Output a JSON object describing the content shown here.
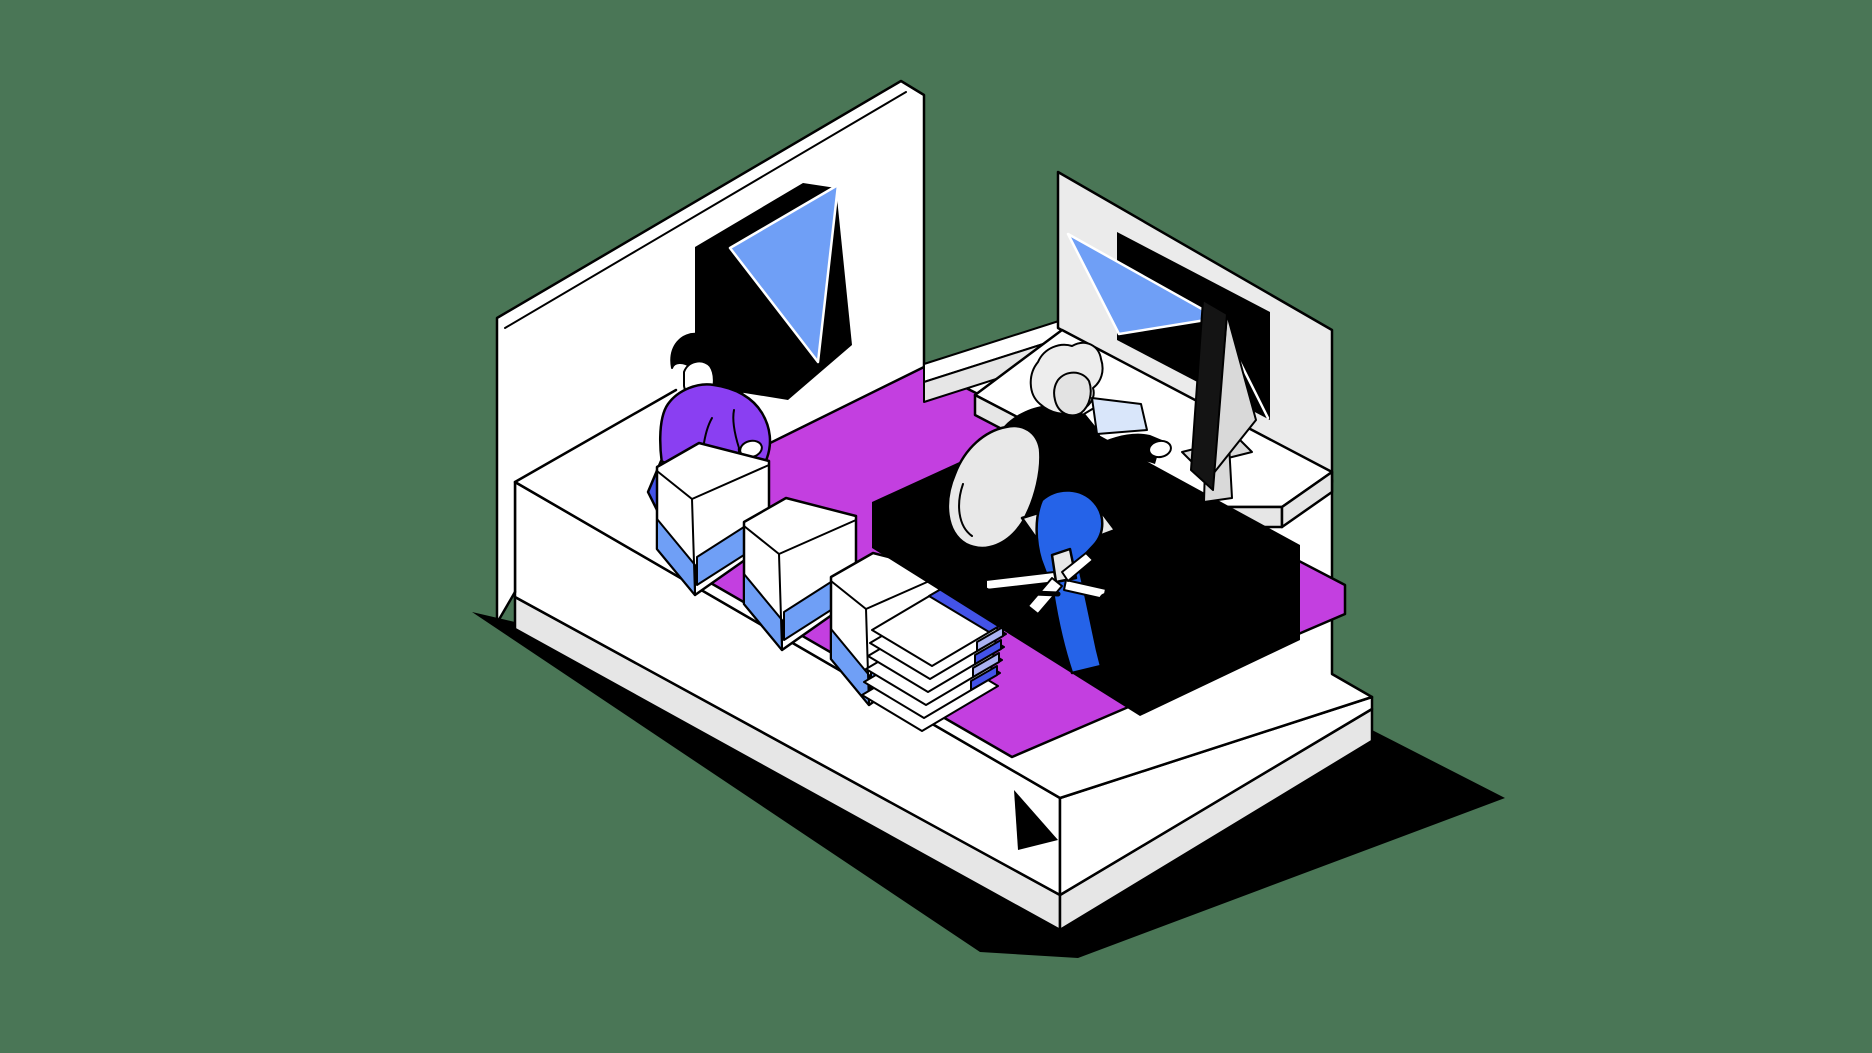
{
  "illustration": {
    "name": "isometric-office-shipping-room",
    "description": "Isometric illustration of a floating room: a standing worker in a purple sweater packs white pouches with blue bases on the left, a stack of papers sits on a magenta carpet, and a gray-haired worker in a black sweater and blue jeans sits on an office chair at a white corner desk with a monitor. Two black windows with blue triangular panes sit in the white and gray walls. The platform casts a hard black shadow on a sage green background.",
    "colors": {
      "background": "#4a7656",
      "outline": "#000000",
      "white": "#ffffff",
      "wall_gray": "#ebebeb",
      "skirt_gray": "#e6e6e6",
      "carpet": "#c33fe0",
      "glass_blue": "#6f9ff6",
      "indigo": "#4353e8",
      "periwinkle": "#abb3f2",
      "purple": "#8a3ff2",
      "jeans": "#2563e8",
      "chair_gray": "#e8e8e8",
      "hair_gray": "#ededed",
      "skin": "#e3e3e3",
      "monitor_dark": "#141414",
      "monitor_gray": "#d9d9d9",
      "paper_blue": "#d9e6fa"
    },
    "elements": [
      "drop-shadow",
      "floor-platform",
      "left-wall",
      "carpet",
      "left-window",
      "standing-person",
      "hand-bag",
      "coffee-bags",
      "paper-stack",
      "right-wall",
      "right-window",
      "desk",
      "under-desk-shadow",
      "monitor",
      "seated-person",
      "office-chair"
    ]
  }
}
